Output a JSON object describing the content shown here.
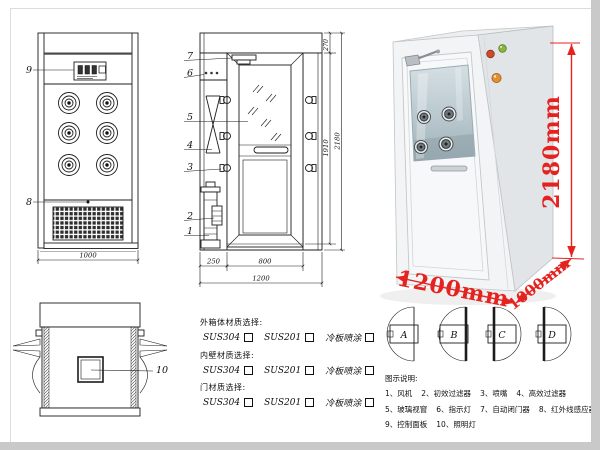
{
  "page": {
    "background": "#ffffff",
    "frame_color": "#c9c9c9"
  },
  "front_view": {
    "part_labels": {
      "control_panel": "9",
      "grille": "8"
    },
    "width_dim": "1000"
  },
  "side_view": {
    "part_labels": {
      "n7": "7",
      "n6": "6",
      "n5": "5",
      "n4": "4",
      "n3": "3",
      "n2": "2",
      "n1": "1"
    },
    "bottom_dims": {
      "left_section": "250",
      "door": "800",
      "total": "1200"
    },
    "height_dims": {
      "top_section": "270",
      "inner": "1910",
      "total": "2180"
    }
  },
  "top_view": {
    "part_label": "10"
  },
  "photo": {
    "height_label": "2180mm",
    "width_label": "1200mm",
    "depth_label": "1000mm",
    "accent_red": "#e42320",
    "button_colors": {
      "green": "#8bb63b",
      "red": "#cd4a2d",
      "amber": "#e2902f"
    }
  },
  "door_configs": {
    "labels": [
      "A",
      "B",
      "C",
      "D"
    ]
  },
  "materials": {
    "sections": [
      {
        "title": "外箱体材质选择:",
        "options": [
          "SUS304",
          "SUS201",
          "冷板喷涂"
        ]
      },
      {
        "title": "内壁材质选择:",
        "options": [
          "SUS304",
          "SUS201",
          "冷板喷涂"
        ]
      },
      {
        "title": "门材质选择:",
        "options": [
          "SUS304",
          "SUS201",
          "冷板喷涂"
        ]
      }
    ]
  },
  "legend": {
    "title": "图示说明:",
    "rows": [
      [
        "1、风机",
        "2、初效过滤器",
        "3、喷嘴",
        "4、高效过滤器"
      ],
      [
        "5、玻璃视窗",
        "6、指示灯",
        "7、自动闭门器",
        "8、红外线感应器"
      ],
      [
        "9、控制面板",
        "10、照明灯"
      ]
    ]
  }
}
